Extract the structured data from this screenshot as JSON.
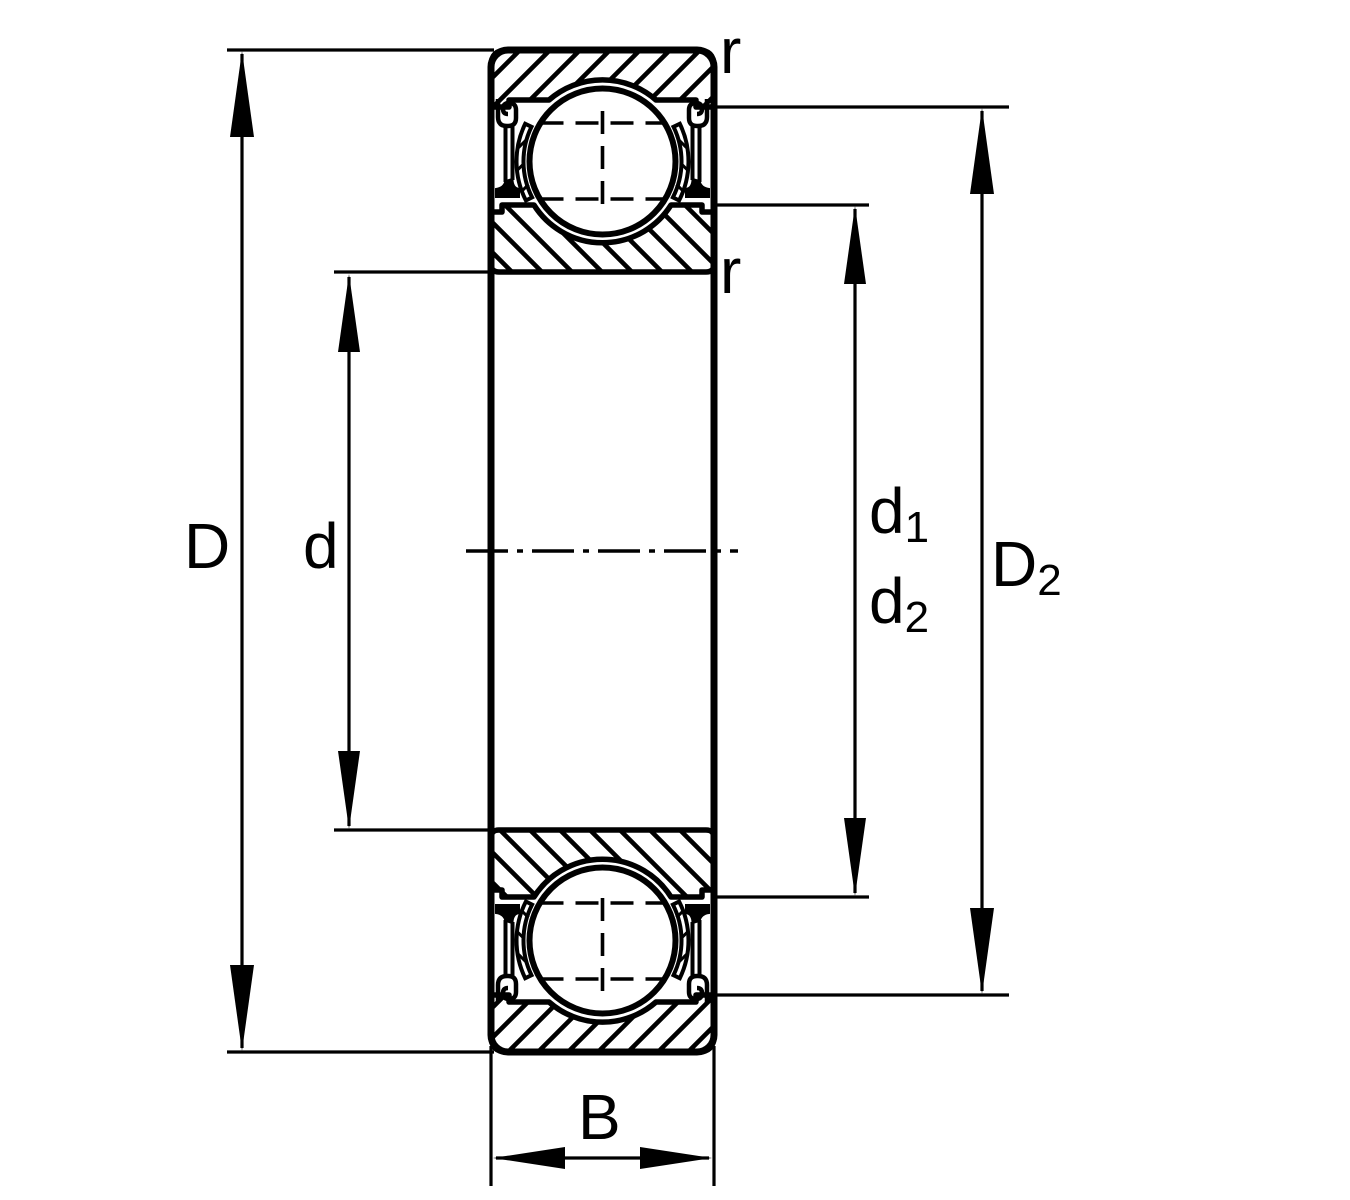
{
  "figure": {
    "kind": "bearing cross-section dimension drawing",
    "background_color": "#ffffff",
    "line_color": "#000000",
    "labels": {
      "D": "D",
      "d": "d",
      "d1": {
        "base": "d",
        "sub": "1"
      },
      "d2": {
        "base": "d",
        "sub": "2"
      },
      "D2": {
        "base": "D",
        "sub": "2"
      },
      "B": "B",
      "r_outer_chamfer": "r",
      "r_inner_chamfer": "r"
    }
  }
}
